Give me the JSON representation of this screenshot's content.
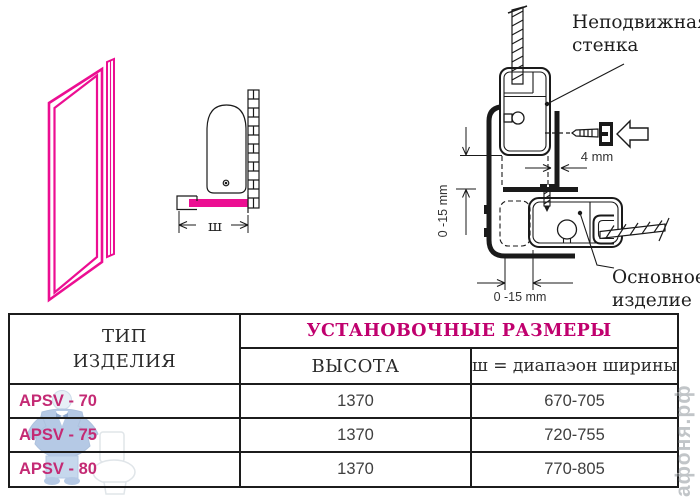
{
  "colors": {
    "magenta": "#ec0e92",
    "table_magenta": "#c42a74",
    "header_magenta": "#c0006e",
    "line": "#1a1a1a"
  },
  "diagram": {
    "fixed_wall_label_line1": "Неподвижная",
    "fixed_wall_label_line2": "стенка",
    "main_product_label_line1": "Основное",
    "main_product_label_line2": "изделие",
    "dim_4mm": "4 mm",
    "dim_side": "0 -15 mm",
    "dim_bottom": "0 -15 mm",
    "width_symbol": "ш"
  },
  "table": {
    "type_header_line1": "ТИП",
    "type_header_line2": "ИЗДЕЛИЯ",
    "group_header": "УСТАНОВОЧНЫЕ РАЗМЕРЫ",
    "sub_headers": [
      "ВЫСОТА",
      "ш = диапаэон ширины"
    ],
    "rows": [
      {
        "type": "APSV - 70",
        "height": "1370",
        "width_range": "670-705"
      },
      {
        "type": "APSV - 75",
        "height": "1370",
        "width_range": "720-755"
      },
      {
        "type": "APSV - 80",
        "height": "1370",
        "width_range": "770-805"
      }
    ]
  },
  "watermark": {
    "site": "афоня.рф"
  }
}
